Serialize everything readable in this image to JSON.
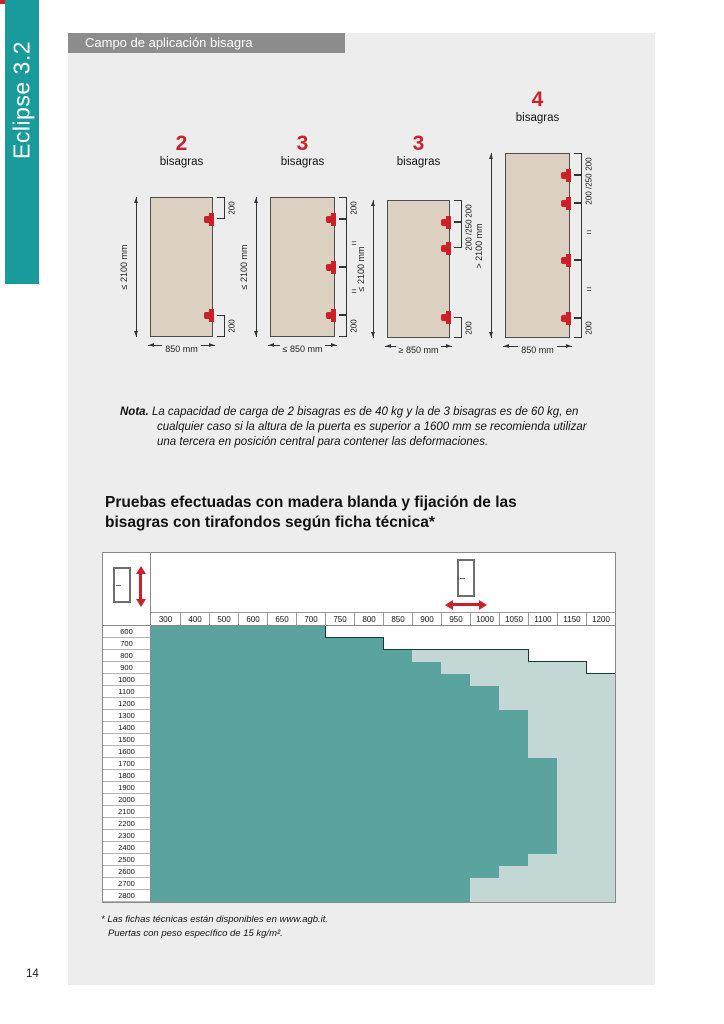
{
  "page": {
    "number": "14"
  },
  "sidebar": {
    "title": "Eclipse 3.2",
    "color": "#1a9b9b",
    "accent_color": "#c9222b"
  },
  "header": {
    "title": "Campo de aplicación bisagra"
  },
  "doors_section": {
    "doors": [
      {
        "count": "2",
        "caption": "bisagras",
        "height_label": "≤ 2100 mm",
        "width_label": "850 mm",
        "hinges": [
          0.16,
          0.84
        ],
        "annotations": [
          {
            "label": "200",
            "from": 0,
            "to": 0.16
          },
          {
            "label": "200",
            "from": 0.84,
            "to": 1
          }
        ]
      },
      {
        "count": "3",
        "caption": "bisagras",
        "height_label": "≤ 2100 mm",
        "width_label": "≤ 850 mm",
        "hinges": [
          0.16,
          0.5,
          0.84
        ],
        "annotations": [
          {
            "label": "200",
            "from": 0,
            "to": 0.16
          },
          {
            "label": "=",
            "from": 0.16,
            "to": 0.5
          },
          {
            "label": "=",
            "from": 0.5,
            "to": 0.84
          },
          {
            "label": "200",
            "from": 0.84,
            "to": 1
          }
        ]
      },
      {
        "count": "3",
        "caption": "bisagras",
        "height_label": "≤ 2100 mm",
        "width_label": "≥ 850 mm",
        "hinges": [
          0.16,
          0.35,
          0.85
        ],
        "annotations": [
          {
            "label": "200",
            "from": 0,
            "to": 0.16
          },
          {
            "label": "200 /250",
            "from": 0.16,
            "to": 0.35
          },
          {
            "label": "200",
            "from": 0.85,
            "to": 1
          }
        ]
      },
      {
        "count": "4",
        "caption": "bisagras",
        "height_label": "> 2100 mm",
        "width_label": "850 mm",
        "hinges": [
          0.12,
          0.27,
          0.58,
          0.89
        ],
        "annotations": [
          {
            "label": "200",
            "from": 0,
            "to": 0.12
          },
          {
            "label": "200 /250",
            "from": 0.12,
            "to": 0.27
          },
          {
            "label": "=",
            "from": 0.27,
            "to": 0.58
          },
          {
            "label": "=",
            "from": 0.58,
            "to": 0.89
          },
          {
            "label": "200",
            "from": 0.89,
            "to": 1
          }
        ]
      }
    ]
  },
  "note": {
    "label": "Nota.",
    "text": " La capacidad de carga de 2 bisagras es de 40 kg y la de 3 bisagras es de 60 kg, en cualquier caso si la altura de la puerta es superior a 1600 mm se recomienda utilizar una tercera en posición central para contener las deformaciones."
  },
  "section_title": "Pruebas efectuadas con madera blanda y fijación de las bisagras con tirafondos según ficha técnica*",
  "chart_data": {
    "type": "heatmap",
    "title": "Pruebas efectuadas con madera blanda y fijación de las bisagras con tirafondos según ficha técnica*",
    "xlabel": "anchura de puerta (mm)",
    "ylabel": "altura de puerta (mm)",
    "columns": [
      300,
      400,
      500,
      600,
      650,
      700,
      750,
      800,
      850,
      900,
      950,
      1000,
      1050,
      1100,
      1150,
      1200
    ],
    "rows": [
      600,
      700,
      800,
      900,
      1000,
      1100,
      1200,
      1300,
      1400,
      1500,
      1600,
      1700,
      1800,
      1900,
      2000,
      2100,
      2200,
      2300,
      2400,
      2500,
      2600,
      2700,
      2800
    ],
    "regions": [
      {
        "id": "2",
        "name": "2 bisagras",
        "color": "#5ba39f",
        "max_width_by_row": [
          700,
          800,
          850,
          900,
          950,
          1000,
          1000,
          1050,
          1050,
          1050,
          1050,
          1100,
          1100,
          1100,
          1100,
          1100,
          1100,
          1100,
          1100,
          1050,
          1000,
          950,
          950
        ]
      },
      {
        "id": "3",
        "name": "3 bisagras",
        "color": "#c3d7d5",
        "max_width_by_row": [
          null,
          null,
          1050,
          1150,
          1200,
          1200,
          1200,
          1200,
          1200,
          1200,
          1200,
          1200,
          1200,
          1200,
          1200,
          1200,
          1200,
          1200,
          1200,
          1200,
          1200,
          1200,
          1200
        ]
      }
    ],
    "boundary_color": "#17393b",
    "legend": {
      "height_icon": "door-with-vertical-arrow",
      "width_icon": "door-with-horizontal-arrow"
    }
  },
  "footnote": {
    "line1": "* Las fichas técnicas están disponibles en www.agb.it.",
    "line2": "Puertas con peso específico de 15 kg/m²."
  },
  "colors": {
    "sidebar_teal": "#1a9b9b",
    "accent_red": "#c9222b",
    "header_gray": "#8d8d8d",
    "content_bg": "#ededed",
    "door_fill": "#dcd1c0",
    "region2": "#5ba39f",
    "region3": "#c3d7d5"
  }
}
